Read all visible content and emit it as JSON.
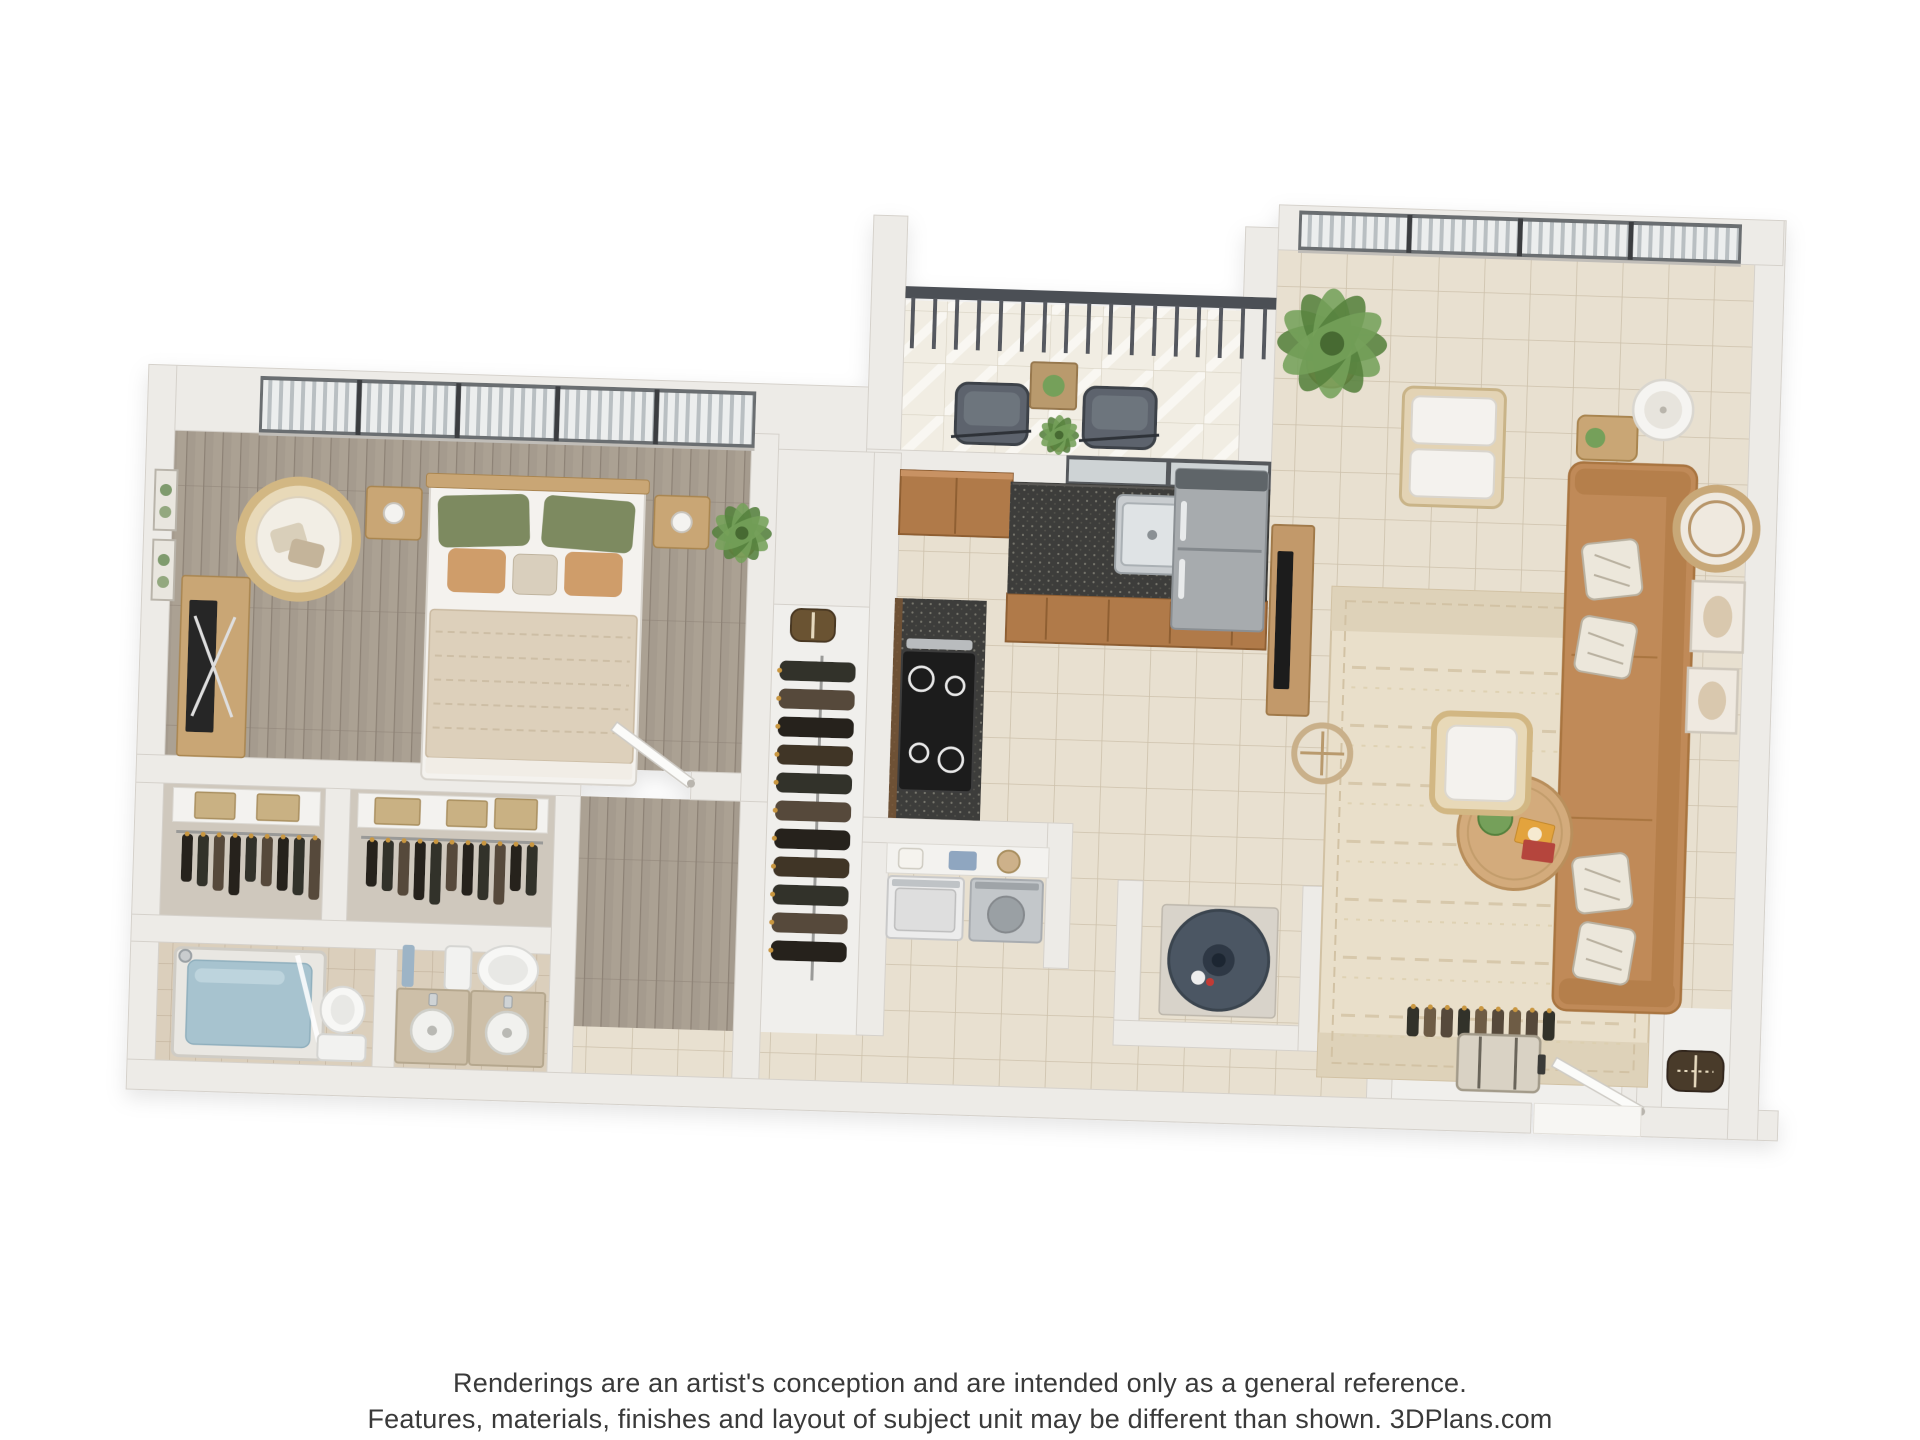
{
  "meta": {
    "kind": "3d-floor-plan-rendering",
    "unit_type": "one-bedroom-one-bath-apartment",
    "background": "#ffffff",
    "plan_rotation_deg": 1.8
  },
  "footer": {
    "line1": "Renderings are an artist's conception and are intended only as a general reference.",
    "line2": "Features, materials, finishes and layout of subject unit may be different than shown. 3DPlans.com",
    "brand": "3DPlans.com"
  },
  "palette": {
    "wall": "#edebe7",
    "wallEdge": "#d5d1cb",
    "wallShadow": "#dedad4",
    "woodFloor": "#a59b8e",
    "woodLine": "#8d8276",
    "woodLight": "#b2a89a",
    "tileFill": "#e8e0d0",
    "tileLine": "#cdc1ab",
    "tileSmFill": "#dbcfbc",
    "tileSmLine": "#c2b29c",
    "balcFill": "#f1ede3",
    "counter": "#3e3d3b",
    "counterFleck": "#77766d",
    "cabinet": "#b07a49",
    "cabinetDark": "#8f5f33",
    "cabinetLight": "#c89263",
    "steel": "#c6cacd",
    "steelDark": "#9aa0a4",
    "sofa": "#c08a58",
    "sofaDark": "#a9743f",
    "rug": "#e9dfca",
    "rugLine": "#d2c2a4",
    "rugBand": "#ded2b9",
    "woodFurn": "#c9a674",
    "woodFurnDark": "#a9854f",
    "white": "#f4f2ee",
    "whiteEdge": "#d8d4cd",
    "green": "#74a05a",
    "greenDark": "#55813d",
    "pillowGreen": "#7d8a60",
    "pillowTan": "#cf9d6b",
    "blanket": "#ddd0bb",
    "blanketLine": "#c9b9a0",
    "water": "#a7c3cf",
    "heater": "#4b5663",
    "heaterDark": "#2f3944",
    "grayChair": "#5d646d",
    "grayChairDark": "#3e434a",
    "railing": "#4b4f54",
    "frameDark": "#55585b",
    "glass": "#ced3d5",
    "clothes1": "#33302b",
    "clothes2": "#57493a",
    "clothes3": "#26231f",
    "rattan": "#d2b783",
    "rattanFill": "#e8d9b8",
    "text": "#3a3a3a"
  },
  "rooms": [
    {
      "id": "bedroom",
      "floor": "wood",
      "x": 168,
      "y": 455,
      "w": 577,
      "h": 325
    },
    {
      "id": "hallway",
      "floor": "wood",
      "x": 585,
      "y": 808,
      "w": 160,
      "h": 230
    },
    {
      "id": "closet-a",
      "floor": "plain",
      "fill": "#cfc8bd",
      "x": 168,
      "y": 808,
      "w": 162,
      "h": 132
    },
    {
      "id": "closet-b",
      "floor": "plain",
      "fill": "#cfc8bd",
      "x": 355,
      "y": 808,
      "w": 205,
      "h": 132
    },
    {
      "id": "bathroom-shower-room",
      "floor": "tile_small",
      "x": 168,
      "y": 967,
      "w": 217,
      "h": 118
    },
    {
      "id": "bathroom-vanity-room",
      "floor": "tile_small",
      "x": 407,
      "y": 967,
      "w": 153,
      "h": 118
    },
    {
      "id": "wardrobe-nook",
      "floor": "plain",
      "fill": "#f0efec",
      "x": 772,
      "y": 610,
      "w": 96,
      "h": 428
    },
    {
      "id": "kitchen",
      "floor": "tile",
      "x": 895,
      "y": 485,
      "w": 370,
      "h": 335
    },
    {
      "id": "living-room",
      "floor": "tile_poly",
      "points": [
        [
          1265,
          240
        ],
        [
          1742,
          240
        ],
        [
          1742,
          1085
        ],
        [
          585,
          1085
        ],
        [
          585,
          1038
        ],
        [
          895,
          1038
        ],
        [
          895,
          820
        ],
        [
          1265,
          820
        ]
      ]
    },
    {
      "id": "balcony",
      "floor": "balcony",
      "x": 894,
      "y": 302,
      "w": 371,
      "h": 150
    },
    {
      "id": "entry-closet-a",
      "floor": "plain",
      "fill": "#f0efec",
      "x": 1405,
      "y": 985,
      "w": 230,
      "h": 100
    },
    {
      "id": "entry-closet-b",
      "floor": "plain",
      "fill": "#f0efec",
      "x": 1675,
      "y": 985,
      "w": 67,
      "h": 100
    }
  ],
  "walls": [
    {
      "id": "outer-top-bedroom",
      "x": 140,
      "y": 390,
      "w": 730,
      "h": 65
    },
    {
      "id": "outer-left",
      "x": 140,
      "y": 390,
      "w": 28,
      "h": 725
    },
    {
      "id": "outer-bottom-a",
      "x": 140,
      "y": 1085,
      "w": 1405,
      "h": 30
    },
    {
      "id": "outer-bottom-b",
      "x": 1655,
      "y": 1085,
      "w": 137,
      "h": 30
    },
    {
      "id": "outer-right",
      "x": 1742,
      "y": 195,
      "w": 30,
      "h": 920
    },
    {
      "id": "balcony-left-column",
      "x": 860,
      "y": 218,
      "w": 34,
      "h": 262
    },
    {
      "id": "balcony-kitchen-divider",
      "x": 860,
      "y": 452,
      "w": 405,
      "h": 33
    },
    {
      "id": "living-top",
      "x": 1265,
      "y": 195,
      "w": 505,
      "h": 45
    },
    {
      "id": "living-left",
      "x": 1232,
      "y": 218,
      "w": 33,
      "h": 255
    },
    {
      "id": "bedroom-south-a",
      "x": 140,
      "y": 780,
      "w": 445,
      "h": 28
    },
    {
      "id": "bedroom-south-b",
      "x": 695,
      "y": 780,
      "w": 77,
      "h": 28
    },
    {
      "id": "bedroom-right",
      "x": 745,
      "y": 440,
      "w": 27,
      "h": 368
    },
    {
      "id": "closet-divider",
      "x": 330,
      "y": 808,
      "w": 25,
      "h": 135
    },
    {
      "id": "bath-north",
      "x": 140,
      "y": 940,
      "w": 430,
      "h": 27
    },
    {
      "id": "bath-divider",
      "x": 385,
      "y": 967,
      "w": 22,
      "h": 118
    },
    {
      "id": "hall-west",
      "x": 560,
      "y": 808,
      "w": 25,
      "h": 277
    },
    {
      "id": "hall-east",
      "x": 745,
      "y": 808,
      "w": 27,
      "h": 277
    },
    {
      "id": "wardrobe-east",
      "x": 868,
      "y": 455,
      "w": 27,
      "h": 583
    },
    {
      "id": "wardrobe-top-block",
      "x": 772,
      "y": 455,
      "w": 96,
      "h": 155
    },
    {
      "id": "laundry-top",
      "x": 868,
      "y": 820,
      "w": 210,
      "h": 25
    },
    {
      "id": "laundry-right",
      "x": 1053,
      "y": 820,
      "w": 25,
      "h": 145
    },
    {
      "id": "heater-left",
      "x": 1125,
      "y": 875,
      "w": 25,
      "h": 165
    },
    {
      "id": "heater-bottom",
      "x": 1125,
      "y": 1015,
      "w": 210,
      "h": 25
    },
    {
      "id": "heater-right",
      "x": 1310,
      "y": 875,
      "w": 25,
      "h": 165
    },
    {
      "id": "entry-closet1-left",
      "x": 1380,
      "y": 985,
      "w": 25,
      "h": 100
    },
    {
      "id": "entry-closet1-right",
      "x": 1635,
      "y": 985,
      "w": 25,
      "h": 100
    },
    {
      "id": "entry-closet2-left",
      "x": 1650,
      "y": 985,
      "w": 25,
      "h": 100
    }
  ],
  "windows": [
    {
      "id": "bedroom-windows",
      "x": 252,
      "y": 398,
      "w": 496,
      "h": 57,
      "panels": 5,
      "style": "blinds"
    },
    {
      "id": "living-windows",
      "x": 1285,
      "y": 200,
      "w": 443,
      "h": 40,
      "panels": 4,
      "style": "blinds"
    },
    {
      "id": "kitchen-window",
      "x": 1060,
      "y": 452,
      "w": 205,
      "h": 30,
      "panels": 2,
      "style": "dark"
    }
  ],
  "railing": {
    "id": "balcony-railing",
    "x": 894,
    "y": 288,
    "w": 371,
    "h": 62
  },
  "furniture": [
    {
      "id": "bed",
      "kind": "bed",
      "x": 425,
      "y": 498,
      "w": 215,
      "h": 298
    },
    {
      "id": "nightstand-left",
      "kind": "nightstand",
      "x": 362,
      "y": 505,
      "w": 55,
      "h": 52
    },
    {
      "id": "nightstand-right",
      "kind": "nightstand",
      "x": 650,
      "y": 505,
      "w": 55,
      "h": 52
    },
    {
      "id": "hanging-egg-chair",
      "kind": "egg_chair",
      "cx": 295,
      "cy": 560,
      "r": 58
    },
    {
      "id": "media-console",
      "kind": "console",
      "x": 180,
      "y": 600,
      "w": 68,
      "h": 180
    },
    {
      "id": "wall-art-1",
      "kind": "wall_art",
      "x": 150,
      "y": 495,
      "w": 22,
      "h": 60
    },
    {
      "id": "wall-art-2",
      "kind": "wall_art",
      "x": 150,
      "y": 565,
      "w": 22,
      "h": 60
    },
    {
      "id": "bedroom-plant",
      "kind": "plant",
      "cx": 738,
      "cy": 540,
      "r": 30
    },
    {
      "id": "bedroom-door",
      "kind": "door",
      "hx": 695,
      "hy": 792,
      "len": 96,
      "angle": -145
    },
    {
      "id": "closet-a-shelf",
      "kind": "closet_shelf",
      "x": 178,
      "y": 812,
      "w": 147,
      "h": 120,
      "boxes": [
        [
          200,
          816,
          40,
          26
        ],
        [
          262,
          816,
          42,
          26
        ]
      ]
    },
    {
      "id": "closet-b-shelf",
      "kind": "closet_shelf",
      "x": 363,
      "y": 812,
      "w": 190,
      "h": 120,
      "boxes": [
        [
          380,
          816,
          45,
          26
        ],
        [
          452,
          816,
          40,
          26
        ],
        [
          500,
          813,
          42,
          30
        ]
      ]
    },
    {
      "id": "shower-tub",
      "kind": "shower",
      "x": 185,
      "y": 972,
      "w": 150,
      "h": 108
    },
    {
      "id": "toilet-main",
      "kind": "toilet_v",
      "x": 330,
      "y": 1002,
      "w": 48,
      "h": 78
    },
    {
      "id": "toilet-guest",
      "kind": "toilet_h",
      "x": 455,
      "y": 958,
      "w": 95,
      "h": 52
    },
    {
      "id": "towel-hook",
      "kind": "towel",
      "x": 412,
      "y": 962,
      "w": 12,
      "h": 42
    },
    {
      "id": "vanity-sink-1",
      "kind": "vanity",
      "x": 408,
      "y": 1006,
      "w": 72,
      "h": 74
    },
    {
      "id": "vanity-sink-2",
      "kind": "vanity",
      "x": 482,
      "y": 1006,
      "w": 74,
      "h": 74
    },
    {
      "id": "wardrobe-basket",
      "kind": "basket",
      "x": 790,
      "y": 614,
      "w": 44,
      "h": 32
    },
    {
      "id": "wardrobe-clothes",
      "kind": "clothes_rail_v",
      "x": 772,
      "y": 660,
      "w": 96,
      "h": 325
    },
    {
      "id": "kitchen-upper-cabinets",
      "kind": "upper_cab",
      "x": 895,
      "y": 472,
      "w": 112,
      "h": 64
    },
    {
      "id": "kitchen-sink-counter",
      "kind": "counter_top",
      "x": 1005,
      "y": 480,
      "w": 260,
      "h": 112,
      "faceH": 48
    },
    {
      "id": "kitchen-sink",
      "kind": "sink_double",
      "x": 1112,
      "y": 490,
      "w": 134,
      "h": 78
    },
    {
      "id": "fridge",
      "kind": "fridge",
      "x": 1170,
      "y": 462,
      "w": 92,
      "h": 160
    },
    {
      "id": "range-counter",
      "kind": "counter_side",
      "x": 893,
      "y": 600,
      "w": 92,
      "h": 220
    },
    {
      "id": "stove",
      "kind": "stove",
      "x": 902,
      "y": 652,
      "w": 74,
      "h": 140
    },
    {
      "id": "laundry-shelf",
      "kind": "laundry_shelf",
      "x": 893,
      "y": 845,
      "w": 162,
      "h": 30
    },
    {
      "id": "washer",
      "kind": "washer",
      "x": 895,
      "y": 878,
      "w": 76,
      "h": 62
    },
    {
      "id": "dryer",
      "kind": "dryer",
      "x": 978,
      "y": 878,
      "w": 72,
      "h": 62
    },
    {
      "id": "water-heater",
      "kind": "water_heater",
      "cx": 1228,
      "cy": 952,
      "r": 50
    },
    {
      "id": "balcony-chair-1",
      "kind": "patio_chair",
      "x": 948,
      "y": 383,
      "w": 72,
      "h": 60
    },
    {
      "id": "balcony-chair-2",
      "kind": "patio_chair",
      "x": 1076,
      "y": 383,
      "w": 72,
      "h": 60
    },
    {
      "id": "balcony-table",
      "kind": "patio_table",
      "x": 1022,
      "y": 360,
      "w": 46,
      "h": 46
    },
    {
      "id": "balcony-plant",
      "kind": "plant",
      "cx": 1052,
      "cy": 432,
      "r": 20
    },
    {
      "id": "tv-console",
      "kind": "tv_console",
      "x": 1268,
      "y": 515,
      "w": 42,
      "h": 190
    },
    {
      "id": "living-plant",
      "kind": "plant",
      "cx": 1322,
      "cy": 332,
      "r": 55
    },
    {
      "id": "armchair-white",
      "kind": "armchair",
      "x": 1395,
      "y": 373,
      "w": 102,
      "h": 118
    },
    {
      "id": "area-rug",
      "kind": "rug",
      "x": 1330,
      "y": 575,
      "w": 330,
      "h": 490
    },
    {
      "id": "sofa",
      "kind": "sofa_v",
      "x": 1563,
      "y": 443,
      "w": 128,
      "h": 548
    },
    {
      "id": "sofa-side-table",
      "kind": "side_table",
      "x": 1570,
      "y": 396,
      "w": 60,
      "h": 44
    },
    {
      "id": "floor-lamp",
      "kind": "lamp",
      "cx": 1655,
      "cy": 388,
      "r": 30
    },
    {
      "id": "wall-mirror",
      "kind": "mirror",
      "cx": 1712,
      "cy": 505,
      "r": 40
    },
    {
      "id": "wall-frame-1",
      "kind": "frame",
      "x": 1690,
      "y": 558,
      "w": 52,
      "h": 70
    },
    {
      "id": "wall-frame-2",
      "kind": "frame",
      "x": 1688,
      "y": 645,
      "w": 50,
      "h": 64
    },
    {
      "id": "coffee-table",
      "kind": "coffee_table",
      "cx": 1520,
      "cy": 815,
      "r": 57
    },
    {
      "id": "floor-hoop-decor",
      "kind": "hoop",
      "cx": 1325,
      "cy": 742,
      "r": 28
    },
    {
      "id": "rattan-chair",
      "kind": "rattan_chair",
      "x": 1436,
      "y": 698,
      "w": 96,
      "h": 98
    },
    {
      "id": "entry-door",
      "kind": "door",
      "hx": 1655,
      "hy": 1090,
      "len": 100,
      "angle": -152
    },
    {
      "id": "entry-threshold",
      "kind": "threshold",
      "x": 1548,
      "y": 1085,
      "w": 107,
      "h": 30
    },
    {
      "id": "entry-closet-items",
      "kind": "entry_items",
      "x": 1412,
      "y": 988,
      "w": 218,
      "h": 92
    },
    {
      "id": "duffel-bag",
      "kind": "duffel",
      "x": 1680,
      "y": 1028,
      "w": 56,
      "h": 40
    }
  ]
}
